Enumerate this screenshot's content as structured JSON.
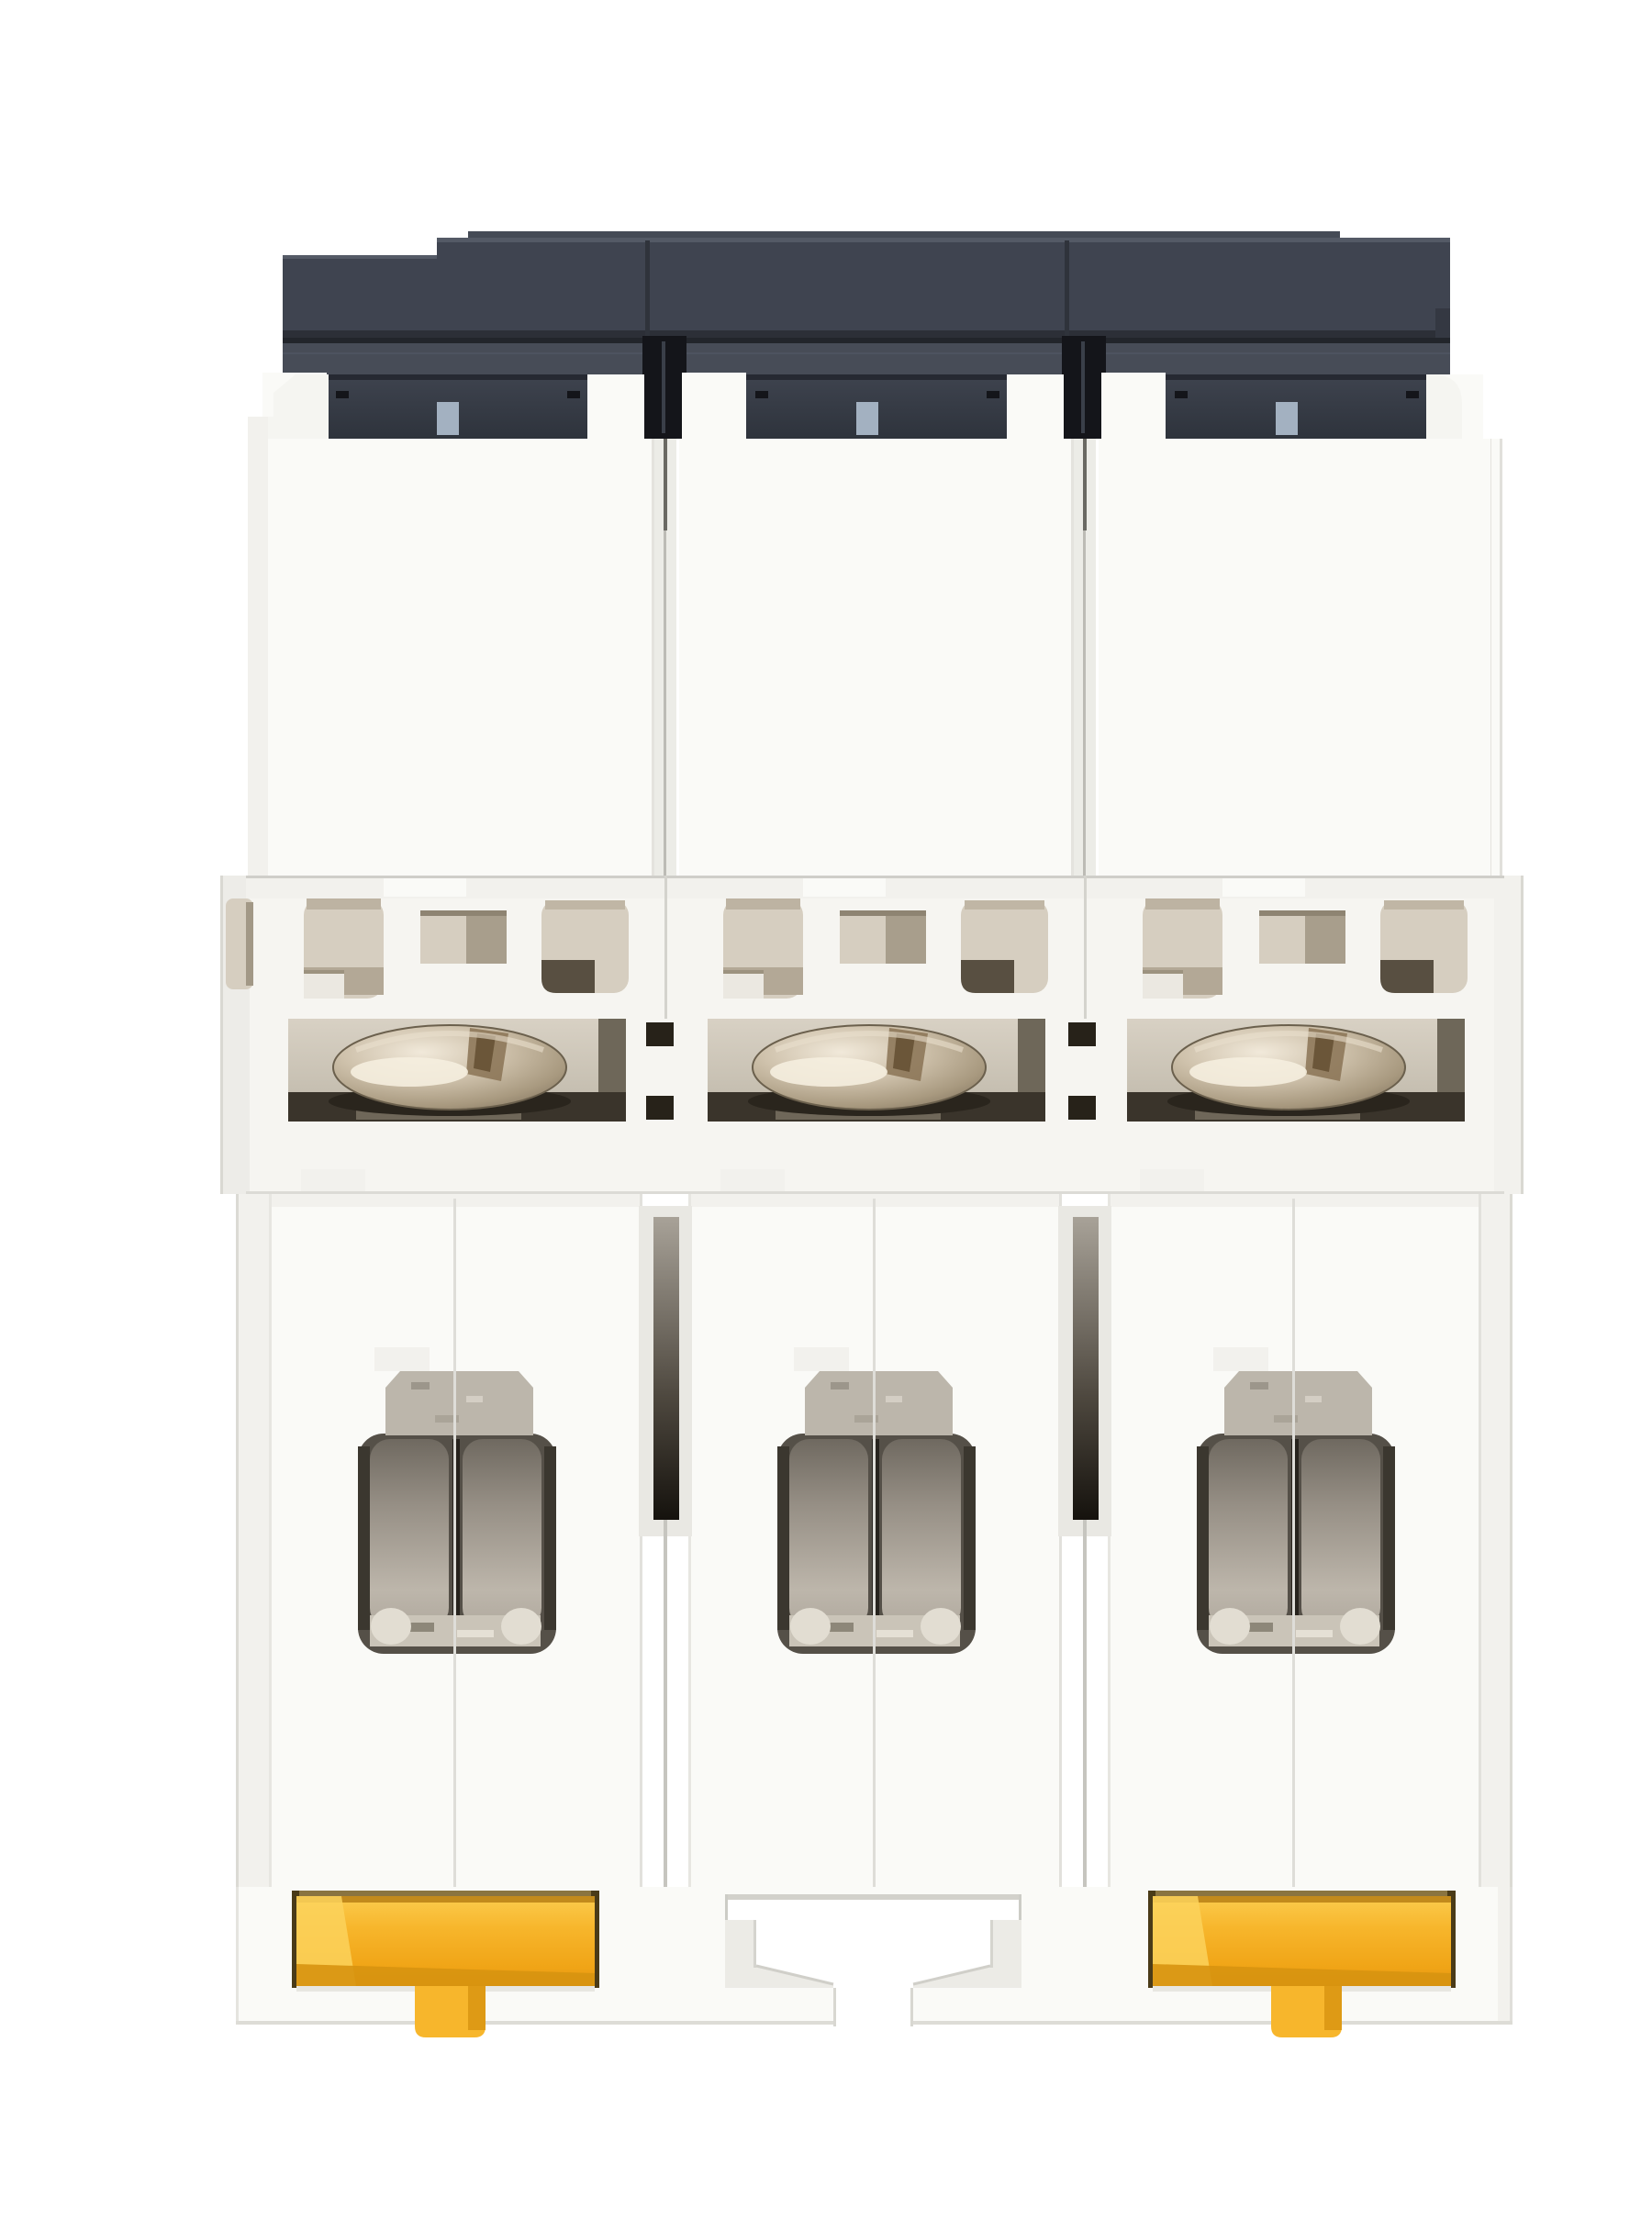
{
  "image": {
    "type": "product-photo",
    "subject": "Three-pole DIN-rail miniature circuit breaker",
    "view": "bottom terminal side, straight-on studio shot on white background",
    "description": "Bottom view of a white 3-pole miniature circuit breaker: dark slate housing cap at top, three beige ventilation windows, three nickel terminal clamp screws, three dark terminal cable openings with metal clamps, and yellow DIN-rail release clips on the outer poles with a rail notch on the middle pole."
  },
  "device": {
    "pole_count": 3,
    "poles": [
      {
        "label": "pole-1",
        "terminal_screw": "pozidriv clamp screw",
        "terminal_opening": "cable clamp cavity",
        "din_clip": "yellow release clip"
      },
      {
        "label": "pole-2",
        "terminal_screw": "pozidriv clamp screw",
        "terminal_opening": "cable clamp cavity",
        "din_clip": "rail notch (no clip)"
      },
      {
        "label": "pole-3",
        "terminal_screw": "pozidriv clamp screw",
        "terminal_opening": "cable clamp cavity",
        "din_clip": "yellow release clip"
      }
    ],
    "components": {
      "housing_cap": "dark slate front cap",
      "body": "white molded housing",
      "vent_windows": "beige ventilation and test windows",
      "latch_tabs": "light blue-gray latch tabs",
      "rail_notch": "DIN-rail notch on middle pole"
    }
  },
  "colors": {
    "background": "#ffffff",
    "body_white": "#fafaf7",
    "body_tint": "#f2f1ed",
    "body_shadow": "#dddcd6",
    "seam_gray": "#c6c5bf",
    "cap_face": "#3f4450",
    "cap_light": "#545a66",
    "cap_band_top": "#3d424d",
    "cap_band_bottom": "#2e333c",
    "cap_groove": "#22252b",
    "slot_black": "#14151a",
    "tab_blue": "#a3b1c1",
    "vent_beige": "#d6cec0",
    "vent_beige_dark": "#a89e8c",
    "vent_deep": "#584f41",
    "recess_top": "#d8d1c4",
    "recess_bottom": "#b0a899",
    "recess_side": "#6e6759",
    "recess_pit": "#3a342b",
    "metal_hi": "#f1e9da",
    "metal_mid": "#cfc2ac",
    "metal_low": "#a8997f",
    "metal_edge": "#7e705c",
    "clamp_metal": "#bcb6ab",
    "cavity_top": "#6f6960",
    "cavity_mid": "#968f85",
    "cavity_low": "#bdb6ab",
    "cavity_rim": "#555048",
    "cavity_divider": "#27231d",
    "sparkle": "#cac4b8",
    "channel_top": "#a8a298",
    "channel_bottom": "#15120d",
    "clip_yellow": "#f7b62c",
    "clip_yellow_hi": "#fbd25c",
    "clip_yellow_deep": "#d79310",
    "clip_slot": "#4a3b18"
  }
}
